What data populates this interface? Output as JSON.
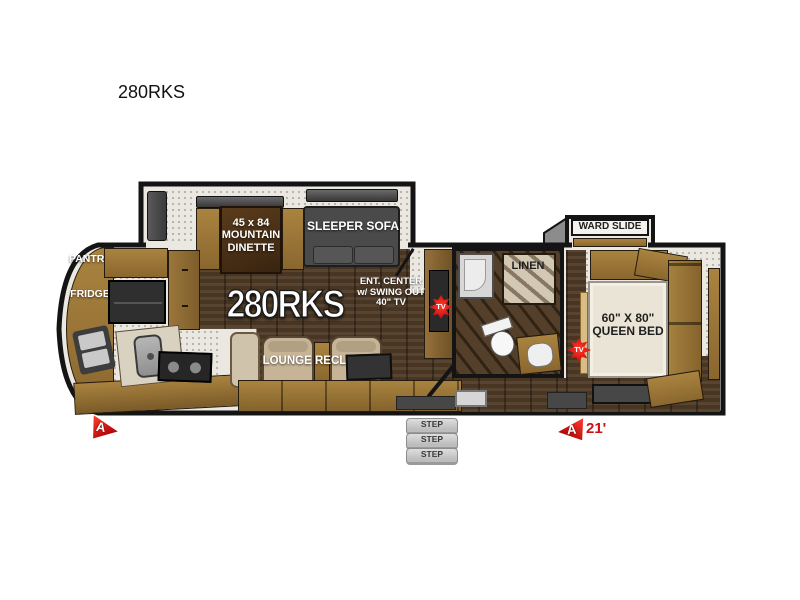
{
  "page": {
    "title": "280RKS"
  },
  "plan": {
    "model_text": "280RKS",
    "labels": {
      "pantry": "PANTRY",
      "fridge": "FRIDGE",
      "dinette": "45 x 84\nMOUNTAIN\nDINETTE",
      "sleeper_sofa": "SLEEPER SOFA",
      "ent_center": "ENT. CENTER\nw/ SWING OUT\n40\" TV",
      "lounge_recliners": "LOUNGE RECLINERS",
      "linen": "LINEN",
      "ward_slide": "WARD SLIDE",
      "queen_bed": "60\" X 80\"\nQUEEN BED",
      "tv_badge": "TV",
      "marker_letter": "A",
      "rear_length": "21'",
      "steps": [
        "STEP",
        "STEP",
        "STEP"
      ]
    },
    "colors": {
      "wall": "#141414",
      "floor_wood": "#4e3a26",
      "cabinet_wood": "#96713f",
      "fixture_dark": "#3f3f3f",
      "carpet_speckle": "#eae8e1",
      "accent_red": "#d01010",
      "mattress": "#eae4d6",
      "step_gray": "#c9c9c9"
    }
  }
}
